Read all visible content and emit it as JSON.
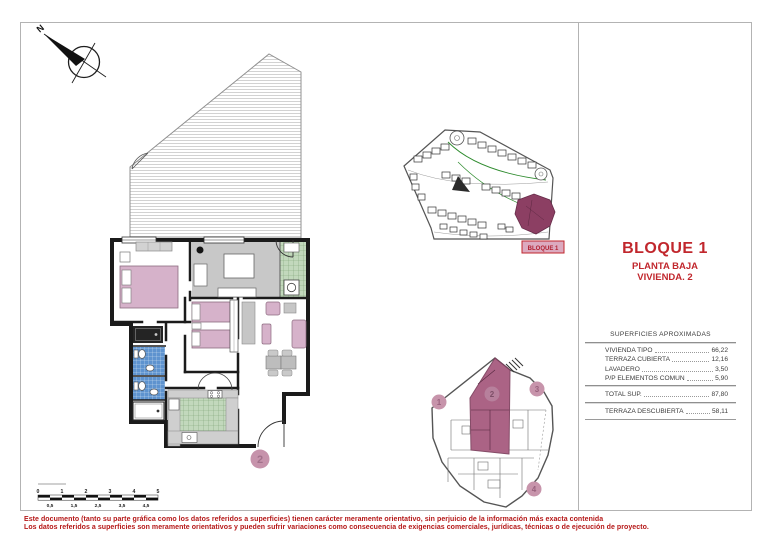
{
  "compass": {
    "north_label": "N"
  },
  "title_block": {
    "block_title": "BLOQUE 1",
    "floor_label": "PLANTA BAJA",
    "unit_label": "VIVIENDA. 2"
  },
  "areas_table": {
    "header": "SUPERFICIES APROXIMADAS",
    "rows": [
      {
        "label": "VIVIENDA TIPO",
        "value": "66,22"
      },
      {
        "label": "TERRAZA CUBIERTA",
        "value": "12,16"
      },
      {
        "label": "LAVADERO",
        "value": "3,50"
      },
      {
        "label": "P/P ELEMENTOS COMUN",
        "value": "5,90"
      }
    ],
    "total": {
      "label": "TOTAL SUP.",
      "value": "87,80"
    },
    "extra": {
      "label": "TERRAZA DESCUBIERTA",
      "value": "58,11"
    }
  },
  "site_plan": {
    "block_label": "BLOQUE 1"
  },
  "floor_plan": {
    "unit_number": "2"
  },
  "key_plan": {
    "unit_numbers": [
      "1",
      "2",
      "3",
      "4"
    ]
  },
  "scale_bar": {
    "top_labels": [
      "0",
      "1",
      "2",
      "3",
      "4",
      "5"
    ],
    "bottom_labels": [
      "0,5",
      "1,5",
      "2,5",
      "3,5",
      "4,5"
    ]
  },
  "disclaimer": {
    "line1": "Este documento (tanto su parte gráfica como los datos referidos a superficies) tienen carácter meramente orientativo, sin perjuicio de la información más exacta contenida",
    "line2": "Los datos referidos a superficies son meramente orientativos y pueden sufrir variaciones como consecuencia de exigencias comerciales, jurídicas, técnicas o de ejecución de proyecto."
  },
  "colors": {
    "accent_red": "#c1272d",
    "disclaimer_red": "#b51717",
    "highlight_mauve": "#c794ab",
    "bed_pink": "#d6b2ca",
    "site_highlight_maroon": "#8c3f63",
    "bath_blue": "#5e93cf",
    "tile_green": "#c2d8bc",
    "floor_gray": "#c8c8c8"
  }
}
